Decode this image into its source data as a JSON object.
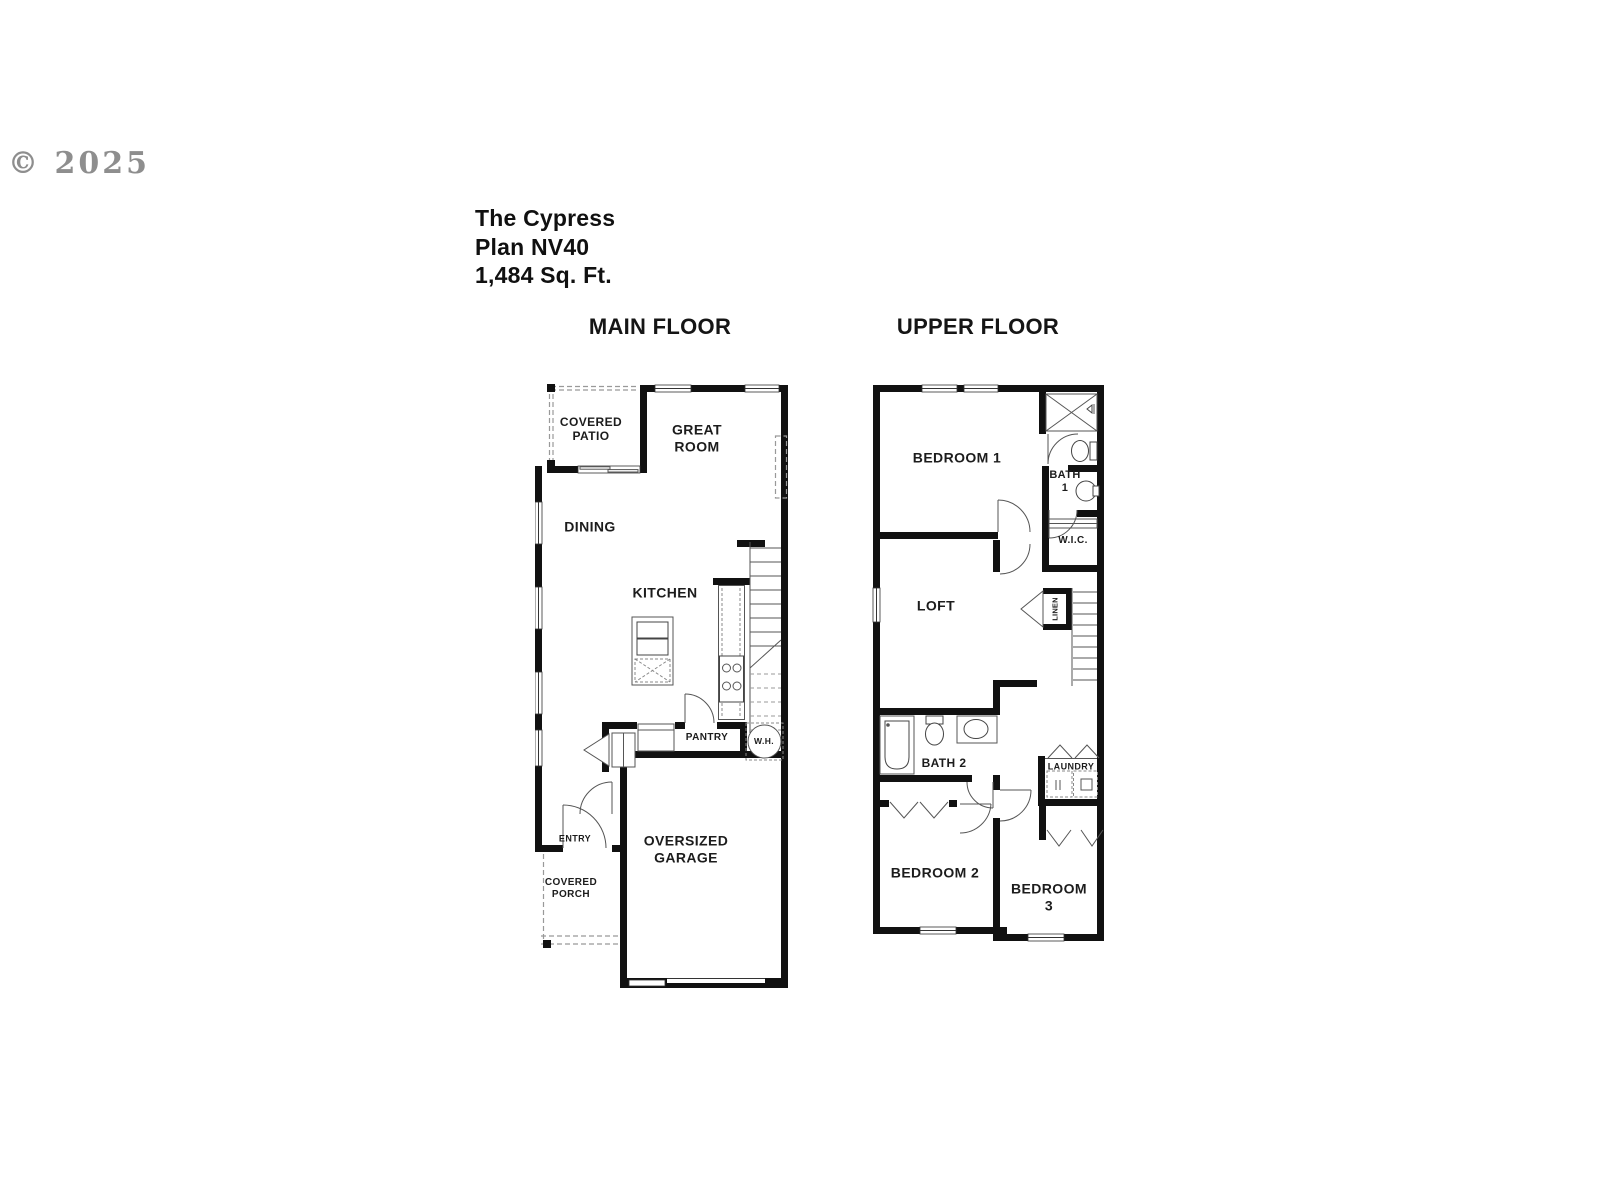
{
  "watermark": "© 2025",
  "plan": {
    "name": "The Cypress",
    "number": "Plan NV40",
    "area": "1,484 Sq. Ft."
  },
  "floors": {
    "main": {
      "heading": "MAIN FLOOR",
      "rooms": {
        "covered_patio": "COVERED\nPATIO",
        "great_room": "GREAT ROOM",
        "dining": "DINING",
        "kitchen": "KITCHEN",
        "pantry": "PANTRY",
        "water_heater": "W.H.",
        "entry": "ENTRY",
        "covered_porch": "COVERED\nPORCH",
        "garage": "OVERSIZED\nGARAGE"
      }
    },
    "upper": {
      "heading": "UPPER FLOOR",
      "rooms": {
        "bedroom1": "BEDROOM 1",
        "bath1": "BATH\n1",
        "wic": "W.I.C.",
        "loft": "LOFT",
        "linen": "LINEN",
        "bath2": "BATH 2",
        "laundry": "LAUNDRY",
        "bedroom2": "BEDROOM 2",
        "bedroom3": "BEDROOM 3"
      }
    }
  },
  "colors": {
    "wall": "#111111",
    "fixture_line": "#555555",
    "dashed_line": "#999999",
    "watermark": "#8e8e8e",
    "label_text": "#1c1c1c"
  }
}
